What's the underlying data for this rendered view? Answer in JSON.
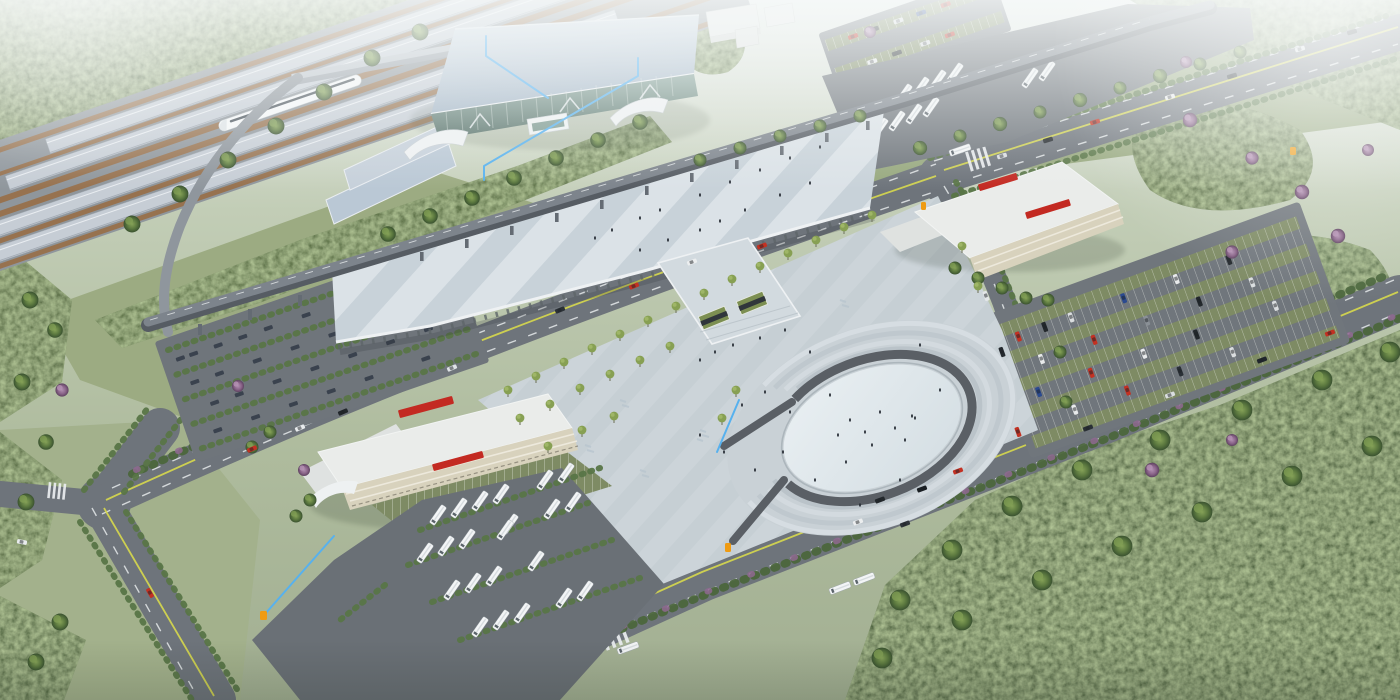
{
  "meta": {
    "title": "Railway station aerial rendering",
    "description": "Bird's-eye 3D architectural rendering of a high-speed railway station complex: platform canopies with a white bullet train, main station hall with arched blue-grey roof and glass curtain wall, elevated approach viaduct, striped pedestrian deck, forecourt plaza with horseshoe-shaped terraced feature, bus terminal and transit buildings with red roof signage, bus and car parking lots, tree-lined roads and surrounding forest, with light-blue annotation leader lines.",
    "view": "aerial oblique",
    "style": "architectural visualization"
  },
  "palette": {
    "haze": "#f0f3f3",
    "lawn": "#97a87e",
    "forest": "#41582f",
    "hedge": "#4b663c",
    "blossom": "#8f6890",
    "asphalt": "#6e747b",
    "asphalt_dark": "#6a7076",
    "lane_yellow": "#d2d44f",
    "lane_white": "#eef1f3",
    "station_roof": "#bac8d5",
    "glass": "#6d8c83",
    "canopy_gray": "#c6cdd5",
    "track_brown": "#97724f",
    "train_white": "#f5f7f8",
    "viaduct": "#565c63",
    "deck_light": "#dbe2e7",
    "deck_shade": "#c8d2d9",
    "plaza": "#ccd4d9",
    "plaza_oval": "#e6edf0",
    "horseshoe": "#5a5f65",
    "building_white": "#eaecea",
    "building_cream": "#d8d2bd",
    "sign_red": "#c32a22",
    "bay_green": "#7e8b64",
    "escalator_green": "#7c8f52",
    "annotation_blue": "#57b1ee",
    "marker_orange": "#ef9b12",
    "car_red": "#c33123",
    "bus_white": "#f3f5f6"
  },
  "scene": {
    "railway": {
      "label": "railway platforms",
      "platform_canopies": 4,
      "train_visible": true
    },
    "station": {
      "label": "main station hall",
      "glass_facade": true,
      "entrance_canopies": 3
    },
    "viaduct": {
      "label": "elevated approach road"
    },
    "deck": {
      "label": "elevated pedestrian deck",
      "striped": true
    },
    "plaza": {
      "label": "forecourt plaza",
      "feature": "horseshoe terraced sunken plaza",
      "scattered_trees": true
    },
    "bus_terminal": {
      "label": "bus terminal building",
      "roof_sign": "red characters (illegible)"
    },
    "transit_building_east": {
      "label": "east transit building",
      "roof_sign": "red characters (illegible)"
    },
    "parking": {
      "bus_lots": 2,
      "car_lots": 3
    },
    "annotations": {
      "leader_lines": 4,
      "markers": 4
    }
  }
}
